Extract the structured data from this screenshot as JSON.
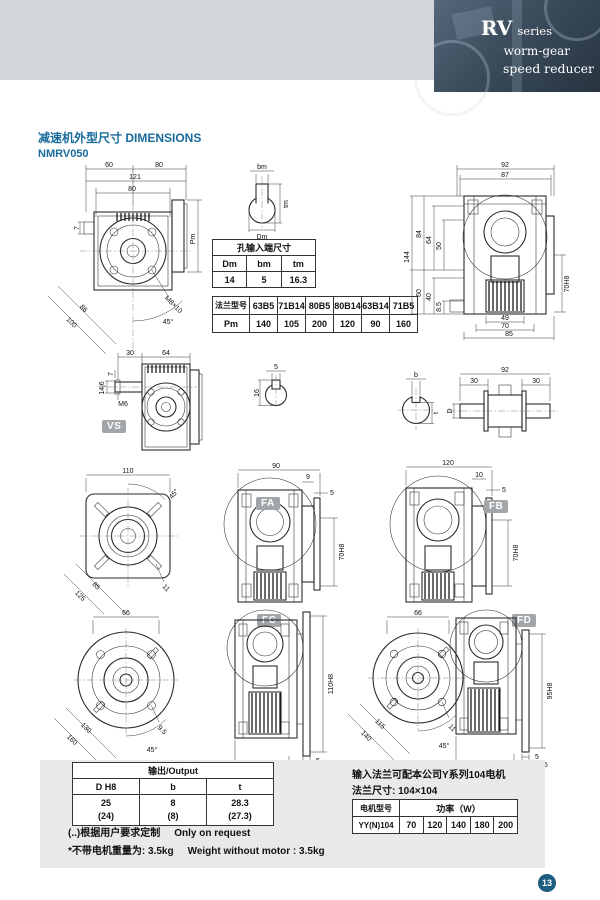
{
  "page": {
    "number": "13",
    "accent_color": "#1a6b9c",
    "tag_color": "#a2a6a9",
    "page_circle_color": "#1d5e80"
  },
  "header": {
    "rv": "RV",
    "series": "series",
    "line2": "worm-gear",
    "line3": "speed reducer"
  },
  "title": {
    "line1": "减速机外型尺寸 DIMENSIONS",
    "line2": "NMRV050"
  },
  "tags": {
    "vs": "VS",
    "fa": "FA",
    "fb": "FB",
    "fc": "FC",
    "fd": "FD"
  },
  "bore_table": {
    "title": "孔输入端尺寸",
    "headers": [
      "Dm",
      "bm",
      "tm"
    ],
    "values": [
      "14",
      "5",
      "16.3"
    ]
  },
  "flange_table": {
    "row1_label": "法兰型号",
    "models": [
      "63B5",
      "71B14",
      "80B5",
      "80B14",
      "63B14",
      "71B5"
    ],
    "row2_label": "Pm",
    "values": [
      "140",
      "105",
      "200",
      "120",
      "90",
      "160"
    ]
  },
  "output_table": {
    "title": "输出/Output",
    "headers": [
      "D H8",
      "b",
      "t"
    ],
    "row1": [
      "25",
      "8",
      "28.3"
    ],
    "row2": [
      "(24)",
      "(8)",
      "(27.3)"
    ]
  },
  "notes": {
    "note1_zh": "(..)根据用户要求定制",
    "note1_en": "Only on request",
    "note2_zh": "*不带电机重量为: 3.5kg",
    "note2_en": "Weight without motor : 3.5kg"
  },
  "motor": {
    "line1": "输入法兰可配本公司Y系列104电机",
    "line2": "法兰尺寸: 104×104",
    "table": {
      "col1_header": "电机型号",
      "col2_header": "功率（W）",
      "model": "YY(N)104",
      "powers": [
        "70",
        "120",
        "140",
        "180",
        "200"
      ]
    }
  },
  "dims": {
    "front": {
      "t1": "60",
      "t2": "80",
      "t3": "121",
      "t4": "80",
      "left": "7",
      "right": "Pm",
      "diag1": "86",
      "diag2": "100",
      "screw": "M8×10",
      "angle": "45°"
    },
    "bore_detail": {
      "top": "bm",
      "right": "tm",
      "bottom": "Dm"
    },
    "side": {
      "t1": "92",
      "t2": "87",
      "l1": "144",
      "l2": "84",
      "l3": "64",
      "l4": "50",
      "l5": "60",
      "l6": "40",
      "l7": "8.5",
      "r1": "70H8",
      "b1": "49",
      "b2": "70",
      "b3": "85"
    },
    "vs": {
      "t1": "30",
      "t2": "64",
      "l1": "7",
      "l2": "14j6",
      "m6": "M6"
    },
    "key_detail": {
      "top": "5",
      "left": "16"
    },
    "shaft_section": {
      "top": "b",
      "right": "t"
    },
    "double_shaft": {
      "top": "92",
      "m1": "30",
      "m2": "30",
      "left": "D"
    },
    "fa_front": {
      "top": "110",
      "angle": "45°",
      "diag1": "85",
      "diag2": "125",
      "slot": "11"
    },
    "fa_side": {
      "top": "90",
      "r1": "9",
      "r2": "5",
      "bore": "70H8"
    },
    "fb_side": {
      "top": "120",
      "r1": "10",
      "r2": "5",
      "bore": "70H8"
    },
    "fc_front": {
      "top": "66",
      "diag1": "130",
      "diag2": "160",
      "slot": "9.5",
      "angle": "45°"
    },
    "fc_side": {
      "bore": "110H8",
      "r1": "5",
      "r2": "10",
      "bottom": "89"
    },
    "fd_front": {
      "top": "66",
      "diag1": "115",
      "diag2": "140",
      "slot": "11",
      "angle": "45°"
    },
    "fd_side": {
      "bore": "95H8",
      "r1": "5",
      "r2": "14.5",
      "bottom": "72"
    }
  }
}
